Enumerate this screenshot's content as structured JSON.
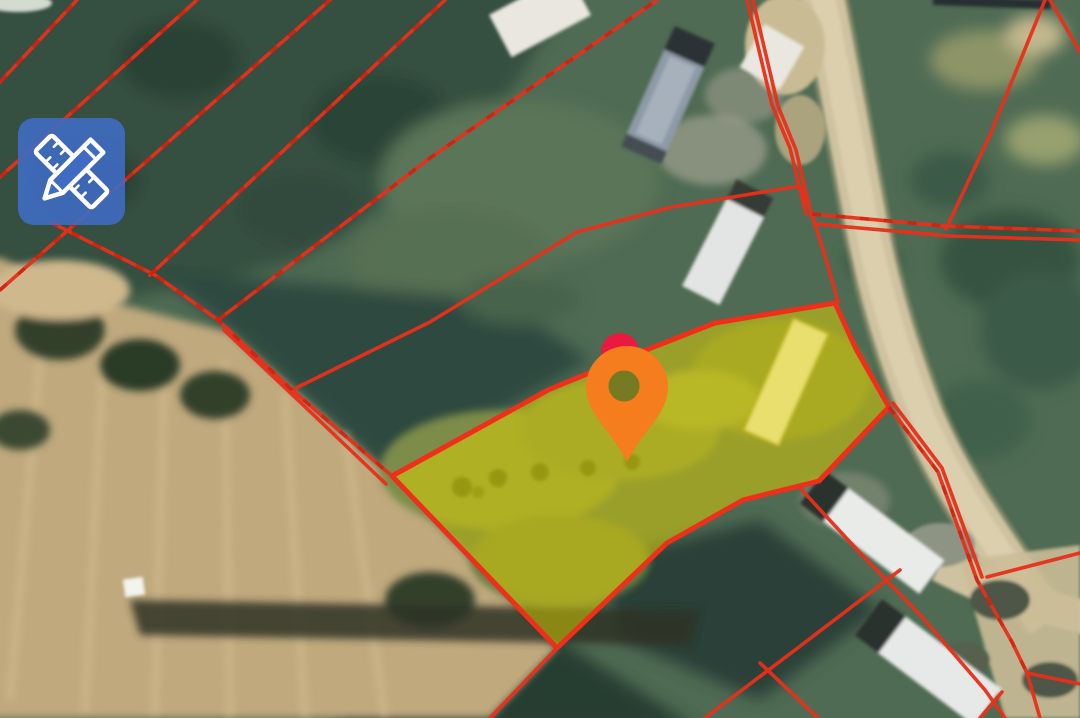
{
  "app": {
    "kind": "satellite-map-parcel-viewer",
    "visible_text": ""
  },
  "toolbar": {
    "measure_button": {
      "icon": "pencil-ruler-icon",
      "fill": "#3f6cc2",
      "icon_color": "#ffffff"
    }
  },
  "map": {
    "imagery": "satellite",
    "boundary_color": "#e8301c",
    "boundary_dash_color": "#c01508",
    "selected_parcel": {
      "points": "392,476 548,390 628,357 715,323 835,303 856,349 889,407 819,481 743,500 667,543 557,648",
      "fill": "#e3d400",
      "fill_opacity": "0.5",
      "stroke": "#ee2f1a"
    },
    "location_pin": {
      "color": "#f57d1e",
      "hole_color": "#767a22",
      "x": 627,
      "y": 462
    },
    "secondary_marker": {
      "color": "#e91a40",
      "x": 620,
      "y": 352
    },
    "terrain_colors": {
      "forest": "#35503f",
      "grass": "#4f6b53",
      "field": "#c0a97d",
      "road": "#cfc2a0"
    }
  }
}
